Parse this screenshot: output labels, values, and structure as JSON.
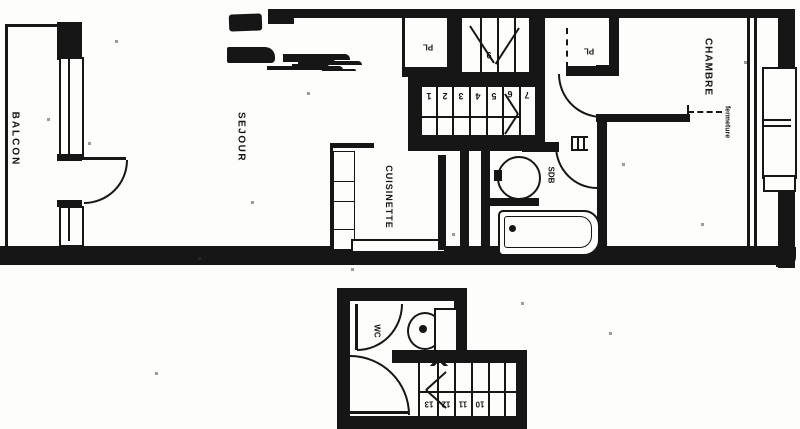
{
  "plan": {
    "colors": {
      "ink": "#161616",
      "paper": "#fdfdfc"
    },
    "labels": {
      "balcon": "BALCON",
      "sejour": "SEJOUR",
      "cuisinette": "CUISINETTE",
      "chambre": "CHAMBRE",
      "sdb": "SDB",
      "wc": "WC",
      "pl_left": "PL",
      "pl_right": "PL",
      "fermeture": "fermeture"
    },
    "stairs": {
      "main_flight_numbers": [
        "1",
        "2",
        "3",
        "4",
        "5",
        "6"
      ],
      "landing_number": "7",
      "upper_flight_number": "9",
      "lower_flight_numbers": [
        "13",
        "12",
        "11",
        "10"
      ]
    }
  }
}
